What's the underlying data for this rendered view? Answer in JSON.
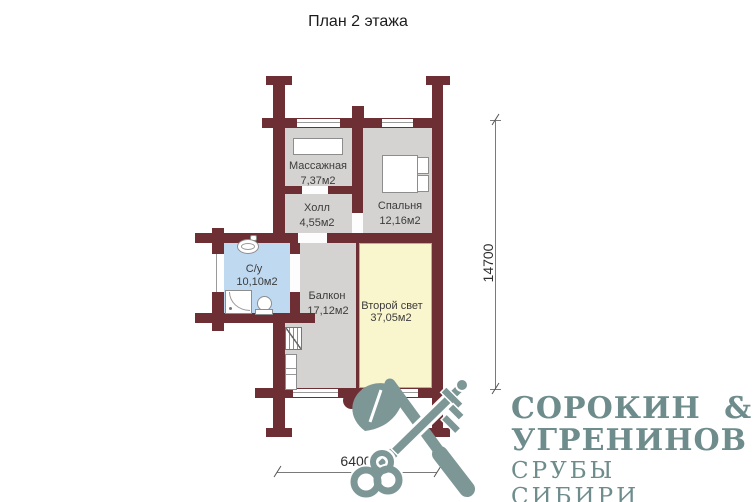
{
  "title": "План 2 этажа",
  "rooms": {
    "massage": {
      "name": "Массажная",
      "area": "7,37м2"
    },
    "hall": {
      "name": "Холл",
      "area": "4,55м2"
    },
    "bedroom": {
      "name": "Спальня",
      "area": "12,16м2"
    },
    "bathroom": {
      "name": "С/у",
      "area": "10,10м2"
    },
    "balcony": {
      "name": "Балкон",
      "area": "17,12м2"
    },
    "second_light": {
      "name": "Второй свет",
      "area": "37,05м2"
    }
  },
  "dimensions": {
    "vertical": "14700",
    "horizontal": "6400"
  },
  "logo": {
    "line1": "СОРОКИН &",
    "line2": "УГРЕНИНОВ",
    "line3": "СРУБЫ СИБИРИ"
  },
  "colors": {
    "wall": "#6e2f34",
    "floor": "#d5d3d1",
    "bathroom": "#bfd9f1",
    "second_light": "#f9f6cd",
    "logo_text": "#6e8c8c",
    "logo_graphic": "#7d9696"
  }
}
